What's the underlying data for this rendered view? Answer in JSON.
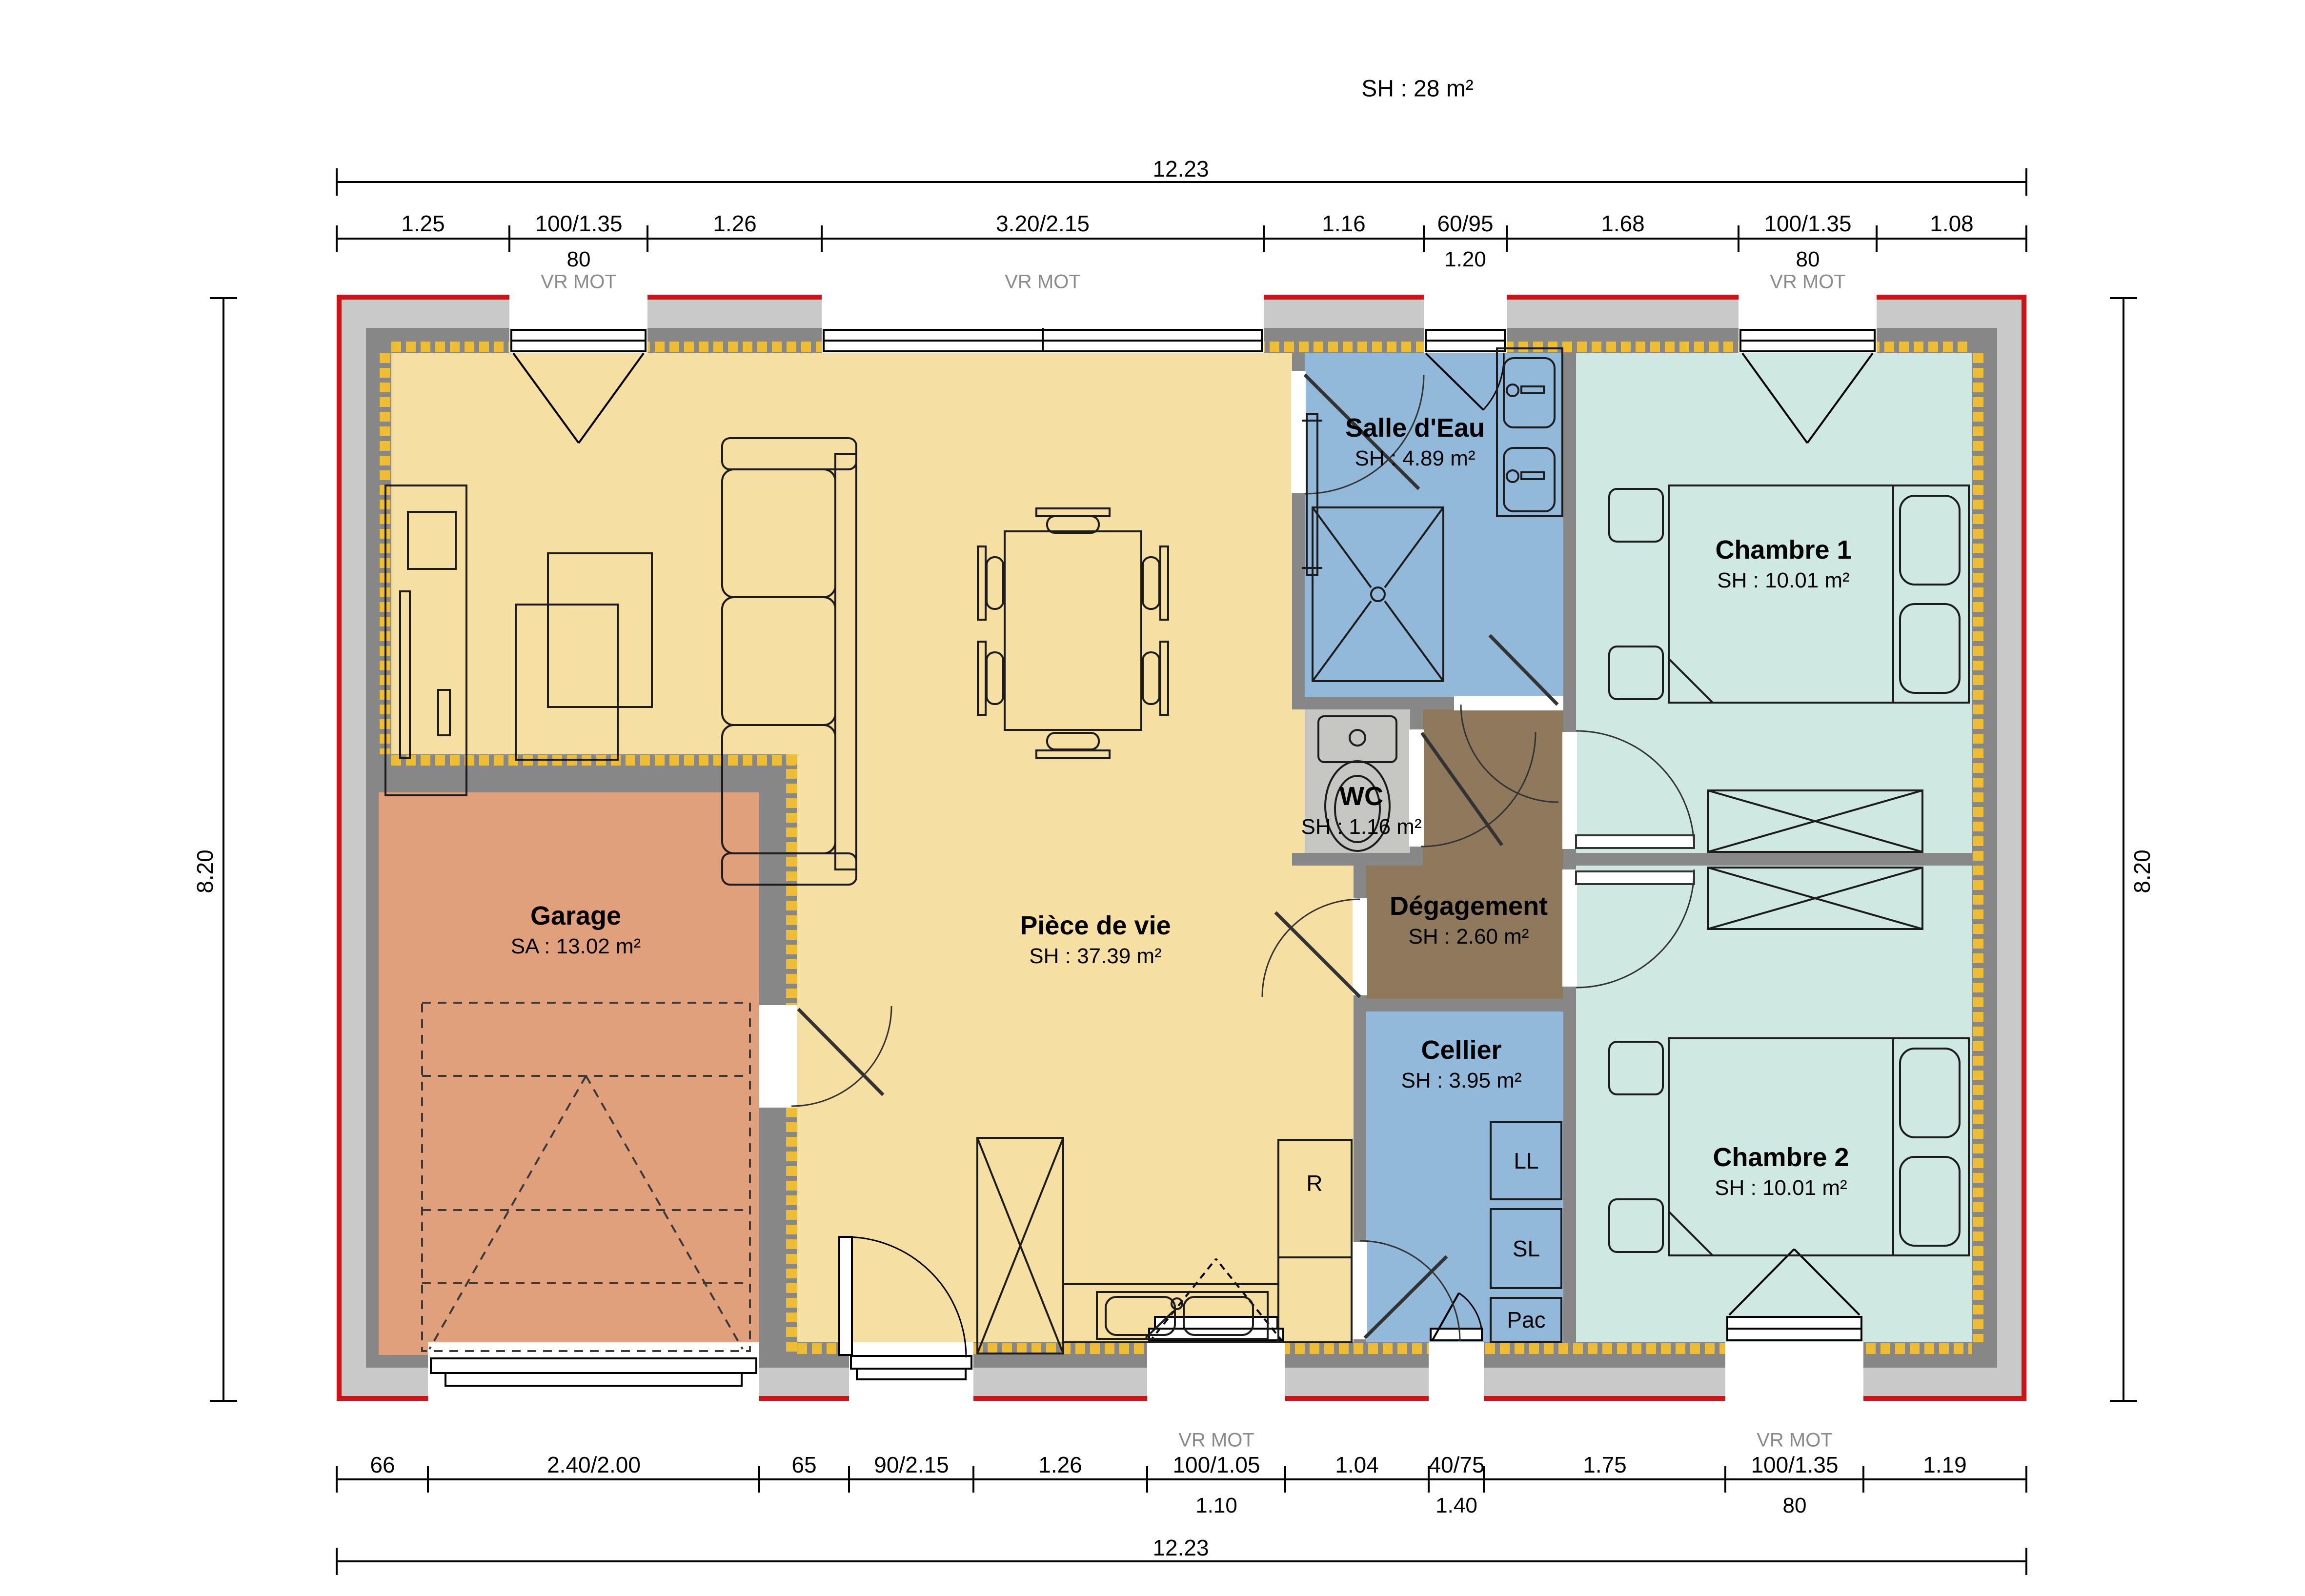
{
  "title": "SH : 28 m²",
  "colors": {
    "exterior_line_red": "#d01216",
    "wall_band_light": "#c9c9c9",
    "wall_dark": "#878787",
    "insulation_yellow": "#eebd33",
    "living_fill": "#f6dfa3",
    "garage_fill": "#e0a07c",
    "wet_room_fill": "#92b9d9",
    "bedroom_fill": "#cfe8e1",
    "wc_fill": "#c6c6c2",
    "hall_fill": "#8f795c"
  },
  "rooms": {
    "piece_de_vie": {
      "name": "Pièce de vie",
      "area": "SH : 37.39 m²"
    },
    "garage": {
      "name": "Garage",
      "area": "SA : 13.02 m²"
    },
    "salle_deau": {
      "name": "Salle d'Eau",
      "area": "SH : 4.89 m²"
    },
    "wc": {
      "name": "WC",
      "area": "SH : 1.16 m²"
    },
    "degagement": {
      "name": "Dégagement",
      "area": "SH : 2.60 m²"
    },
    "cellier": {
      "name": "Cellier",
      "area": "SH : 3.95 m²"
    },
    "chambre1": {
      "name": "Chambre 1",
      "area": "SH : 10.01 m²"
    },
    "chambre2": {
      "name": "Chambre 2",
      "area": "SH : 10.01 m²"
    }
  },
  "appliances": {
    "fridge": "R",
    "washer": "LL",
    "dryer": "SL",
    "heat_pump": "Pac"
  },
  "dims": {
    "total": "12.23",
    "side_left": "8.20",
    "side_right": "8.20",
    "top": {
      "segments": [
        {
          "label": "1.25"
        },
        {
          "label": "100/1.35",
          "sub": "80",
          "note": "VR MOT"
        },
        {
          "label": "1.26"
        },
        {
          "label": "3.20/2.15",
          "note": "VR MOT"
        },
        {
          "label": "1.16"
        },
        {
          "label": "60/95",
          "sub": "1.20"
        },
        {
          "label": "1.68"
        },
        {
          "label": "100/1.35",
          "sub": "80",
          "note": "VR MOT"
        },
        {
          "label": "1.08"
        }
      ]
    },
    "bottom": {
      "segments": [
        {
          "label": "66"
        },
        {
          "label": "2.40/2.00"
        },
        {
          "label": "65"
        },
        {
          "label": "90/2.15"
        },
        {
          "label": "1.26"
        },
        {
          "label": "100/1.05",
          "sub": "1.10",
          "note": "VR MOT"
        },
        {
          "label": "1.04"
        },
        {
          "label": "40/75",
          "sub": "1.40"
        },
        {
          "label": "1.75"
        },
        {
          "label": "100/1.35",
          "sub": "80",
          "note": "VR MOT"
        },
        {
          "label": "1.19"
        }
      ]
    }
  }
}
